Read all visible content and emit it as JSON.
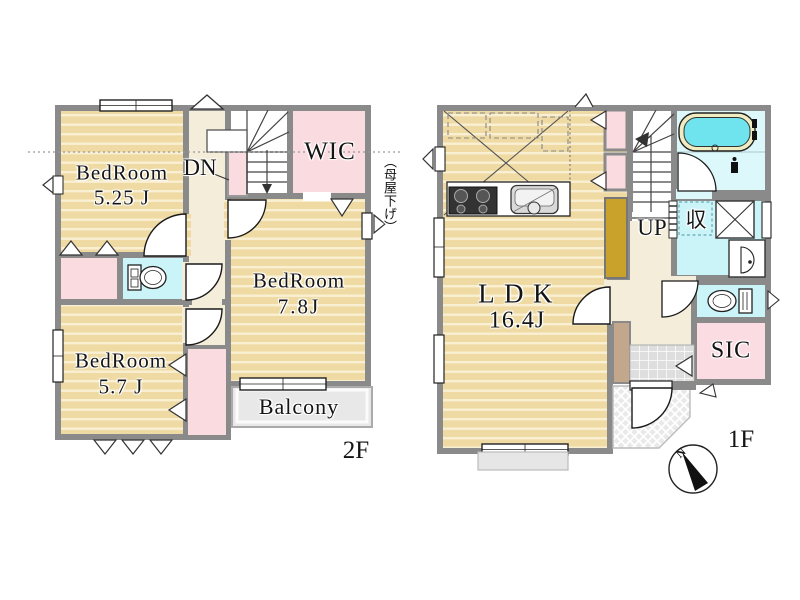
{
  "plan_2f": {
    "floor_label": "2F",
    "rooms": {
      "bedroom_a": {
        "name": "BedRoom",
        "area": "5.25 J"
      },
      "bedroom_b": {
        "name": "BedRoom",
        "area": "7.8J"
      },
      "bedroom_c": {
        "name": "BedRoom",
        "area": "5.7 J"
      },
      "wic": {
        "label": "WIC"
      },
      "balcony": {
        "label": "Balcony"
      }
    },
    "stairs_label": "DN",
    "roof_note": "（母屋下げ）"
  },
  "plan_1f": {
    "floor_label": "1F",
    "rooms": {
      "ldk": {
        "name": "LDK",
        "area": "16.4J"
      },
      "storage": {
        "label": "収"
      },
      "sic": {
        "label": "SIC"
      }
    },
    "stairs_label": "UP",
    "compass": {
      "north_label": "N"
    }
  },
  "colors": {
    "wall_gray": "#8A8A8A",
    "wood_floor_tan": "#EEDAA2",
    "closet_pink": "#FADCE0",
    "sanitary_cyan": "#CBF4F9",
    "hallway_cream": "#F4EDD9",
    "bathtub_water_cyan": "#6FE4EF",
    "cabinet_olive": "#C8A22B",
    "balcony_gray": "#E8E8E8",
    "entry_step_brown": "#C2A78C"
  }
}
